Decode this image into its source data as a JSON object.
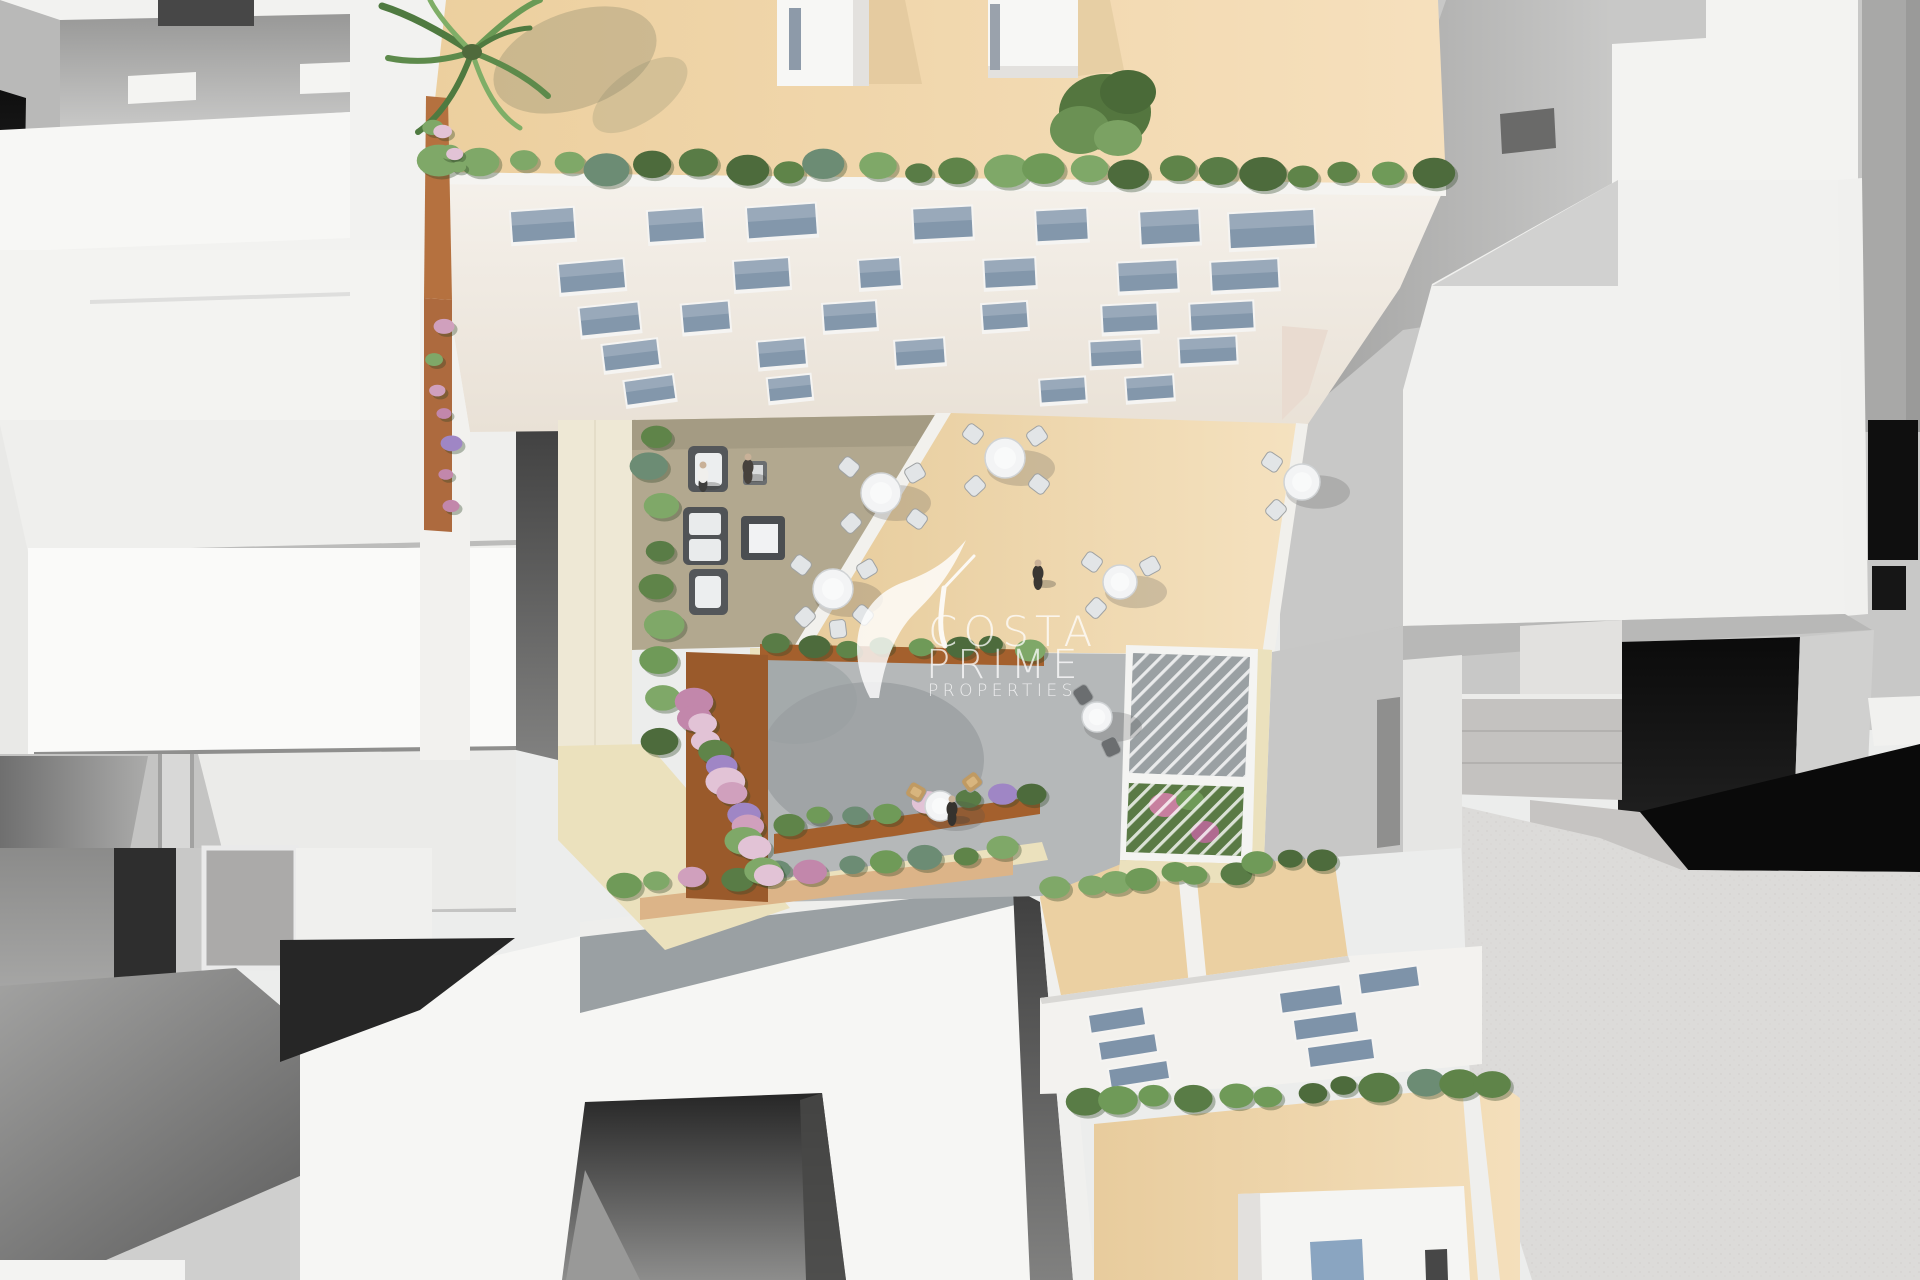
{
  "meta": {
    "description": "Aerial top-down 3D architectural render of a residential block with roof terraces, courtyard garden, pergola and surrounding white massing buildings"
  },
  "watermark": {
    "line1": "COSTA",
    "line2": "PRIME",
    "line3": "PROPERTIES",
    "logo": "hummingbird-logo"
  },
  "palette": {
    "white": "#f5f5f3",
    "off_white": "#efefec",
    "gray_light": "#c8c8c7",
    "gray_mid": "#9a9a99",
    "gray_dark": "#565655",
    "black": "#0d0d0d",
    "roof_beige": "#efd4a6",
    "terrace_beige": "#ecd2a4",
    "terrace_taupe": "#b2a88f",
    "pavement": "#b5b8b9",
    "corten": "#a4602d",
    "tile_cream": "#ebe1bd",
    "tile_tan": "#dcb488",
    "glass": "#8397ab",
    "window_frame": "#f5f4f2",
    "table_white": "#f3f4f5",
    "chair_gray": "#e2e5e7",
    "chair_dark": "#6b6e70",
    "sofa_dark": "#55585a",
    "wicker_tan": "#c09a62",
    "hedge_greens": [
      "#4d6b3c",
      "#5f8449",
      "#6f9a58",
      "#7fa868",
      "#597c46",
      "#6c8c74"
    ],
    "flower_pinks": [
      "#d0a0bd",
      "#c287ab",
      "#e2c3d6",
      "#9f86c5"
    ],
    "watermark_white": "#ffffff"
  },
  "scene": {
    "facade_windows": [
      [
        543,
        226,
        62,
        30,
        -4
      ],
      [
        676,
        226,
        54,
        30,
        -4
      ],
      [
        782,
        222,
        68,
        30,
        -4
      ],
      [
        943,
        224,
        58,
        30,
        -3
      ],
      [
        1062,
        226,
        50,
        30,
        -3
      ],
      [
        1170,
        228,
        58,
        32,
        -3
      ],
      [
        1272,
        230,
        84,
        34,
        -3
      ],
      [
        592,
        277,
        64,
        28,
        -5
      ],
      [
        762,
        275,
        54,
        28,
        -4
      ],
      [
        880,
        274,
        40,
        27,
        -4
      ],
      [
        1010,
        274,
        50,
        27,
        -3
      ],
      [
        1148,
        277,
        58,
        28,
        -3
      ],
      [
        1245,
        276,
        66,
        28,
        -3
      ],
      [
        610,
        320,
        58,
        27,
        -6
      ],
      [
        706,
        318,
        46,
        27,
        -5
      ],
      [
        850,
        317,
        52,
        26,
        -4
      ],
      [
        1005,
        317,
        44,
        25,
        -4
      ],
      [
        1130,
        319,
        54,
        26,
        -3
      ],
      [
        1222,
        317,
        62,
        26,
        -3
      ],
      [
        631,
        356,
        54,
        25,
        -7
      ],
      [
        782,
        354,
        46,
        25,
        -5
      ],
      [
        920,
        353,
        48,
        24,
        -4
      ],
      [
        1116,
        354,
        50,
        24,
        -3
      ],
      [
        1208,
        351,
        56,
        24,
        -3
      ],
      [
        650,
        391,
        48,
        23,
        -8
      ],
      [
        790,
        389,
        42,
        22,
        -6
      ],
      [
        1063,
        391,
        44,
        22,
        -4
      ],
      [
        1150,
        389,
        46,
        22,
        -4
      ]
    ],
    "skylights": [
      [
        1117,
        1020,
        54,
        17,
        -9
      ],
      [
        1128,
        1047,
        56,
        17,
        -9
      ],
      [
        1139,
        1074,
        58,
        17,
        -9
      ],
      [
        1311,
        999,
        60,
        19,
        -8
      ],
      [
        1326,
        1026,
        62,
        19,
        -8
      ],
      [
        1341,
        1053,
        64,
        19,
        -8
      ],
      [
        1389,
        980,
        58,
        19,
        -8
      ]
    ],
    "hedges": [
      {
        "x1": 438,
        "y1": 164,
        "x2": 1434,
        "y2": 174,
        "n": 24,
        "rmin": 13,
        "rmax": 24,
        "seed": 3
      },
      {
        "x1": 652,
        "y1": 432,
        "x2": 662,
        "y2": 738,
        "n": 9,
        "rmin": 14,
        "rmax": 21,
        "seed": 11
      },
      {
        "x1": 775,
        "y1": 644,
        "x2": 1035,
        "y2": 650,
        "n": 8,
        "rmin": 11,
        "rmax": 16,
        "seed": 21
      },
      {
        "x1": 786,
        "y1": 822,
        "x2": 1032,
        "y2": 792,
        "n": 8,
        "rmin": 11,
        "rmax": 16,
        "seed": 31,
        "pink": [
          4,
          6
        ]
      },
      {
        "x1": 618,
        "y1": 886,
        "x2": 1008,
        "y2": 850,
        "n": 11,
        "rmin": 12,
        "rmax": 18,
        "seed": 41,
        "pink": [
          2,
          5
        ]
      },
      {
        "x1": 1060,
        "y1": 890,
        "x2": 1170,
        "y2": 872,
        "n": 5,
        "rmin": 12,
        "rmax": 17,
        "seed": 51
      },
      {
        "x1": 1200,
        "y1": 878,
        "x2": 1328,
        "y2": 856,
        "n": 5,
        "rmin": 12,
        "rmax": 17,
        "seed": 61
      },
      {
        "x1": 1085,
        "y1": 1104,
        "x2": 1498,
        "y2": 1080,
        "n": 12,
        "rmin": 13,
        "rmax": 21,
        "seed": 71
      },
      {
        "x1": 695,
        "y1": 700,
        "x2": 765,
        "y2": 880,
        "n": 14,
        "rmin": 12,
        "rmax": 20,
        "seed": 81,
        "flowers": true
      },
      {
        "x1": 438,
        "y1": 125,
        "x2": 455,
        "y2": 170,
        "n": 5,
        "rmin": 7,
        "rmax": 11,
        "seed": 91,
        "flowers": true
      },
      {
        "x1": 438,
        "y1": 330,
        "x2": 450,
        "y2": 505,
        "n": 7,
        "rmin": 7,
        "rmax": 11,
        "seed": 101,
        "flowers": true
      }
    ],
    "tables": [
      {
        "x": 881,
        "y": 493,
        "r": 20,
        "chairs": [
          [
            -32,
            -26
          ],
          [
            34,
            -20
          ],
          [
            -30,
            30
          ],
          [
            36,
            26
          ]
        ]
      },
      {
        "x": 1005,
        "y": 458,
        "r": 20,
        "chairs": [
          [
            -32,
            -24
          ],
          [
            32,
            -22
          ],
          [
            -30,
            28
          ],
          [
            34,
            26
          ]
        ]
      },
      {
        "x": 833,
        "y": 589,
        "r": 20,
        "chairs": [
          [
            -32,
            -24
          ],
          [
            34,
            -20
          ],
          [
            -28,
            28
          ],
          [
            30,
            26
          ],
          [
            5,
            40
          ]
        ]
      },
      {
        "x": 1302,
        "y": 482,
        "r": 18,
        "chairs": [
          [
            -30,
            -20
          ],
          [
            -26,
            28
          ]
        ]
      },
      {
        "x": 1120,
        "y": 582,
        "r": 17,
        "chairs": [
          [
            -28,
            -20
          ],
          [
            30,
            -16
          ],
          [
            -24,
            26
          ]
        ]
      },
      {
        "x": 1097,
        "y": 717,
        "r": 15,
        "dark": true,
        "chairs": [
          [
            -14,
            -22
          ],
          [
            14,
            30
          ]
        ]
      },
      {
        "x": 940,
        "y": 806,
        "r": 15,
        "wicker": true,
        "chairs": [
          [
            -24,
            -14
          ],
          [
            32,
            -24
          ]
        ]
      }
    ],
    "persons": [
      {
        "x": 703,
        "y": 478,
        "legs": "#3e3e3c",
        "shirt": "#f0efec"
      },
      {
        "x": 748,
        "y": 470,
        "legs": "#46413c"
      },
      {
        "x": 1038,
        "y": 576,
        "legs": "#3a3733"
      },
      {
        "x": 952,
        "y": 812,
        "legs": "#35322e"
      }
    ]
  }
}
